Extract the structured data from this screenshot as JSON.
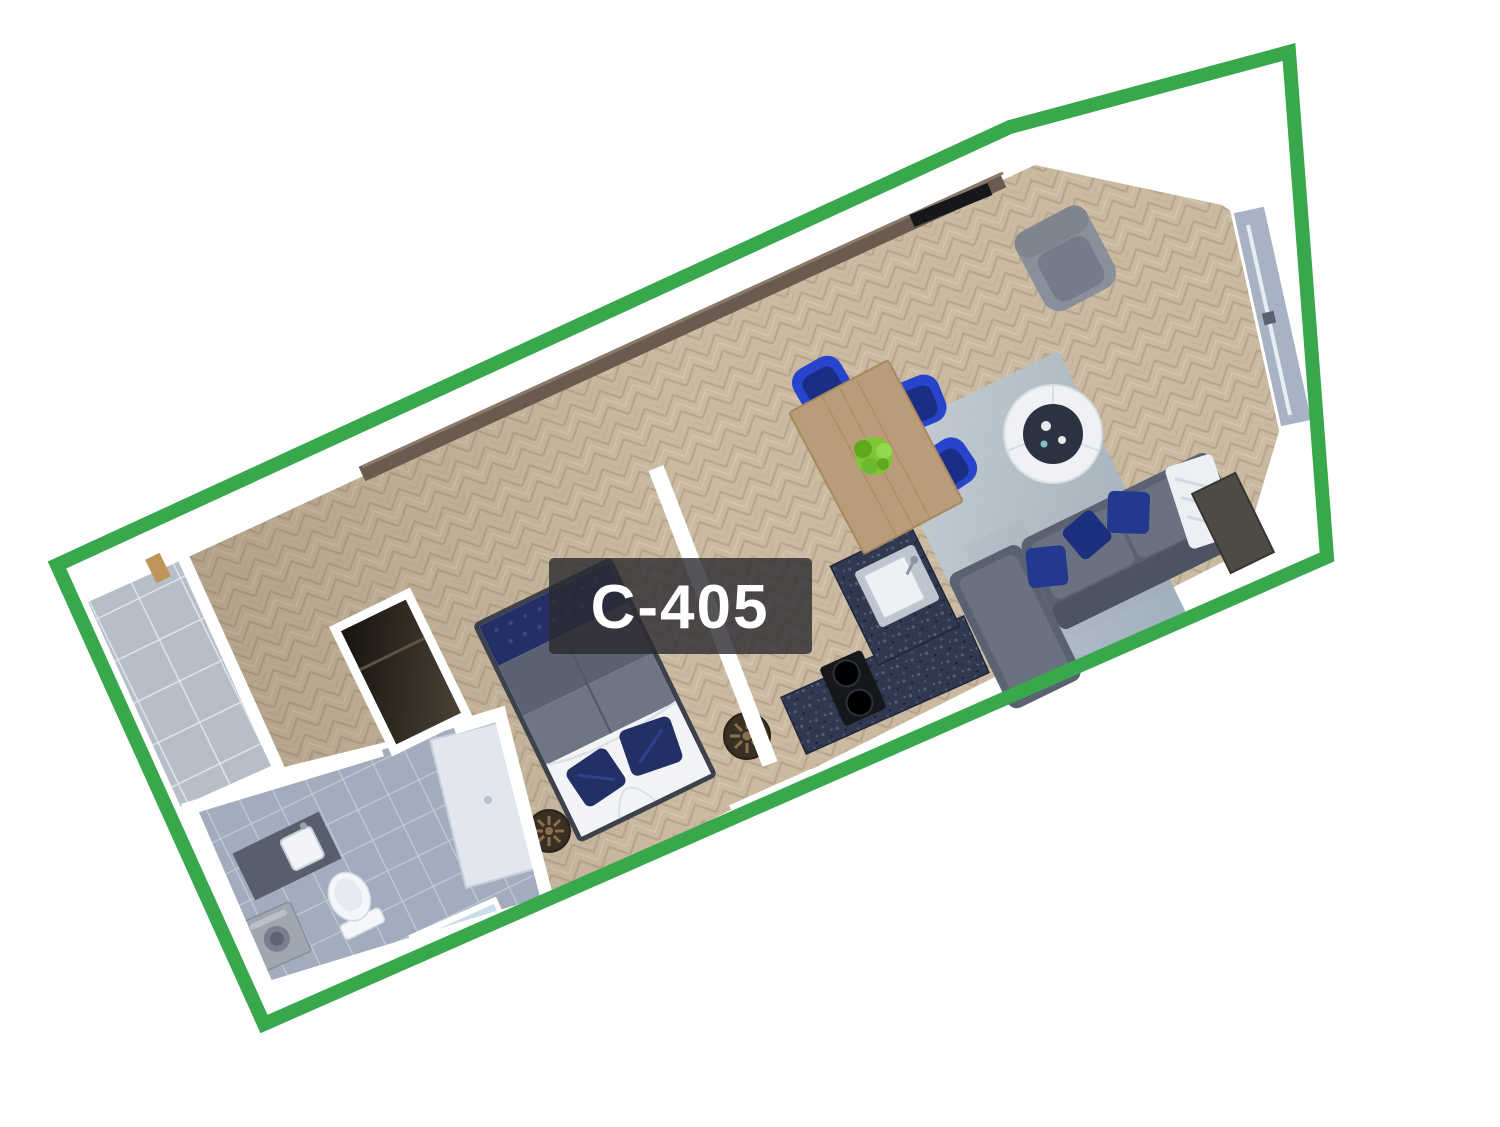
{
  "unit": {
    "label": "C-405"
  },
  "colors": {
    "outline_green": "#39A84D",
    "label_background": "rgba(42,42,48,0.80)",
    "label_text": "#FFFFFF",
    "wood_floor": "#C9BAA1",
    "wood_floor_stripe": "#B7A68B",
    "balcony_tile": "#B6BEC9",
    "bathroom_tile": "#A2ACBC",
    "shower": "#E2E7EF",
    "kitchen_counter_granite": "#313950",
    "cooktop_black": "#15171B",
    "sofa_gray": "#5A6271",
    "pillow_navy": "#22398F",
    "chair_blue": "#2744CC",
    "dining_table_wood": "#B99C79",
    "plant_green": "#7FC637",
    "bed_duvet_gray": "#6E7583",
    "bed_bench_navy": "#232F66",
    "nightstand_brown": "#3A2F23",
    "wardrobe_dark": "#2A231B",
    "console_brown": "#6A5B4E",
    "window_glass": "#CBDDEB",
    "wall_white": "#FFFFFF"
  },
  "objects": [
    "balcony",
    "bathroom",
    "shower",
    "toilet",
    "vanity-sink",
    "washing-machine",
    "wardrobe",
    "bed",
    "nightstand",
    "kitchen-counter",
    "kitchen-sink",
    "cooktop",
    "fridge-cabinet",
    "dining-table",
    "dining-chair",
    "plant",
    "sofa",
    "coffee-table",
    "rug",
    "armchair",
    "tv-console",
    "window"
  ]
}
